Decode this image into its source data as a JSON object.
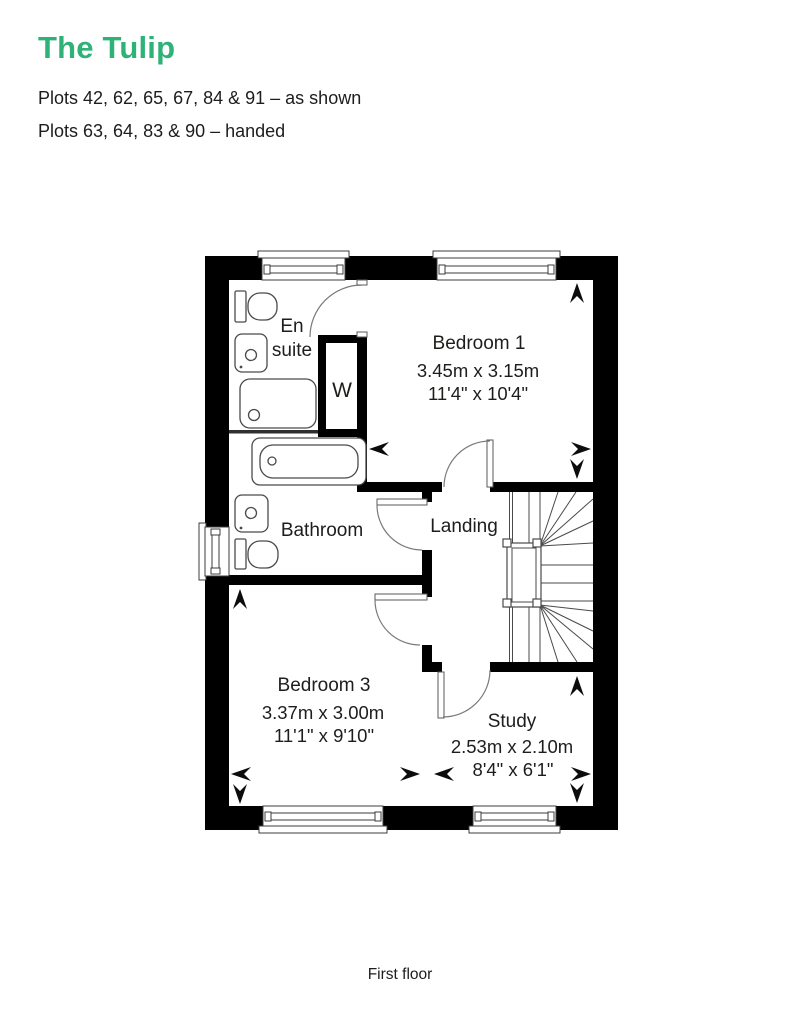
{
  "page": {
    "title": "The Tulip",
    "plots_as_shown": "Plots 42, 62, 65, 67, 84 & 91 – as shown",
    "plots_handed": "Plots 63, 64, 83 & 90 – handed",
    "floor_caption": "First floor"
  },
  "colors": {
    "accent_green": "#2eb278",
    "text": "#1d1d1b",
    "wall": "#000000"
  },
  "rooms": {
    "ensuite": {
      "line1": "En",
      "line2": "suite"
    },
    "wardrobe": {
      "label": "W"
    },
    "bedroom1": {
      "name": "Bedroom 1",
      "metric": "3.45m x 3.15m",
      "imperial": "11'4\" x 10'4\""
    },
    "bathroom": {
      "name": "Bathroom"
    },
    "landing": {
      "name": "Landing"
    },
    "bedroom3": {
      "name": "Bedroom 3",
      "metric": "3.37m x 3.00m",
      "imperial": "11'1\" x 9'10\""
    },
    "study": {
      "name": "Study",
      "metric": "2.53m x 2.10m",
      "imperial": "8'4\" x 6'1\""
    }
  }
}
